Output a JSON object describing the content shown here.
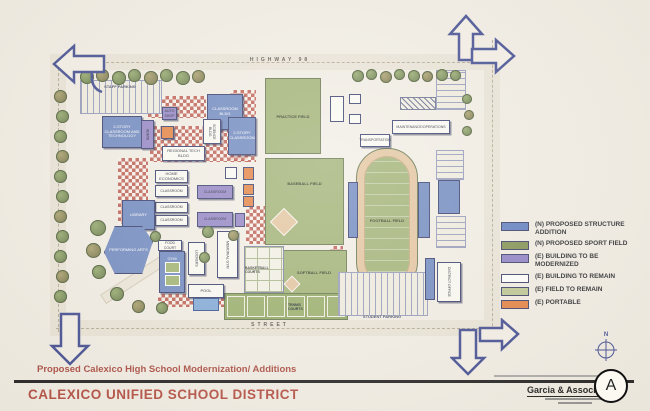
{
  "title_block": {
    "project_title": "Proposed Calexico High School Modernization/ Additions",
    "district_name": "CALEXICO UNIFIED SCHOOL DISTRICT",
    "firm_name": "Garcia & Associates",
    "sheet_letter": "A"
  },
  "compass": {
    "north_label": "N"
  },
  "streets": {
    "top_street": "HIGHWAY 98",
    "bottom_street": "STREET"
  },
  "legend": {
    "items": [
      {
        "label": "(N) PROPOSED STRUCTURE ADDITION",
        "color": "#5c7cc0"
      },
      {
        "label": "(N) PROPOSED SPORT FIELD",
        "color": "#7f8f4d"
      },
      {
        "label": "(E) BUILDING TO BE MODERNIZED",
        "color": "#8d7ec6"
      },
      {
        "label": "(E) BUILDING TO REMAIN",
        "color": "#ffffff"
      },
      {
        "label": "(E) FIELD TO REMAIN",
        "color": "#bcc68e"
      },
      {
        "label": "(E) PORTABLE",
        "color": "#e47e3c"
      }
    ]
  },
  "site": {
    "labels": {
      "staff_parking": "STAFF PARKING",
      "classroom_technology": "2-STORY CLASSROOM AND TECHNOLOGY",
      "classroom_bldg": "CLASSROOM BLDG",
      "admin": "ADMIN",
      "auto_shop": "AUTO SHOP",
      "science": "SCIENCE BLDG",
      "two_story_classroom": "2-STORY CLASSROOM",
      "regional_tech": "REGIONAL TECH BLDG",
      "home_economics": "HOME ECONOMICS",
      "classroom": "CLASSROOM",
      "library": "LIBRARY",
      "performing_arts": "PERFORMING ARTS",
      "food_court": "FOOD COURT",
      "gym": "GYM",
      "lockers": "LOCKERS",
      "memorial_gym": "MEMORIAL GYM",
      "pool": "POOL",
      "basketball": "BASKETBALL COURTS",
      "tennis": "TENNIS COURTS",
      "softball": "SOFTBALL FIELD",
      "baseball": "BASEBALL FIELD",
      "football": "FOOTBALL FIELD",
      "practice": "PRACTICE FIELD",
      "maintenance": "MAINTENANCE/OPERATIONS",
      "transportation": "TRANSPORTATION",
      "student_parking": "STUDENT PARKING",
      "district_office": "DISTRICT OFFICE"
    }
  },
  "colors": {
    "title_red": "#a8453a",
    "plan_navy": "#3c478f",
    "paper": "#f2eee5"
  }
}
